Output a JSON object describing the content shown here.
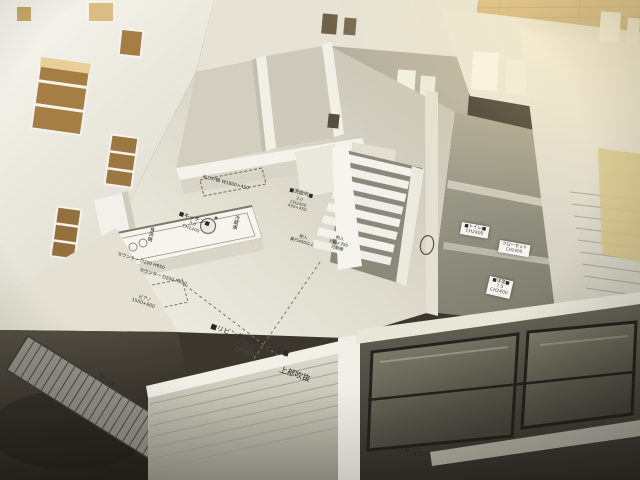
{
  "labels": {
    "living_dining": {
      "title": "■リビング・ダイニング■",
      "area": "15.0",
      "ceiling": "CH2400"
    },
    "void_above": "上部吹抜",
    "kitchen": {
      "title": "■キッチン■",
      "area": "3.0",
      "ceiling": "CH2400"
    },
    "hanging_cupboard": "吊り戸棚 W1800×450",
    "dishwasher": "食洗機",
    "refrigerator": "冷蔵庫",
    "counter_1": "カウンター D250 H950",
    "counter_2": "カウンター D250 H650",
    "washroom": {
      "title": "■洗面所■",
      "area": "2.0",
      "ceiling": "CH2400",
      "note": "450×450"
    },
    "storage_1": {
      "title": "物入",
      "note": "奥行450以上"
    },
    "storage_2": {
      "title": "物入",
      "note": "350×350",
      "note2": "可動棚"
    },
    "toilet": {
      "title": "■トイレ■",
      "ceiling": "CH2400"
    },
    "closet": {
      "title": "クローゼット",
      "ceiling": "CH2400"
    },
    "bedroom": {
      "title": "■洋室■",
      "area": "7.5",
      "ceiling": "CH2400"
    },
    "piano": {
      "title": "ピアノ",
      "size": "1500×600"
    },
    "balcony": "バルコニー",
    "drying_deck": "物干し場"
  },
  "colors": {
    "wall_white": "#f3f1e9",
    "wall_shadow": "#d7d4c8",
    "floor_paper": "#e9e7dd",
    "wood_floor": "#b48a50",
    "wood_bright": "#ecd9a4",
    "table_dark": "#3c372e",
    "balcony_dark": "#44423a",
    "ink": "#2b2a26"
  }
}
